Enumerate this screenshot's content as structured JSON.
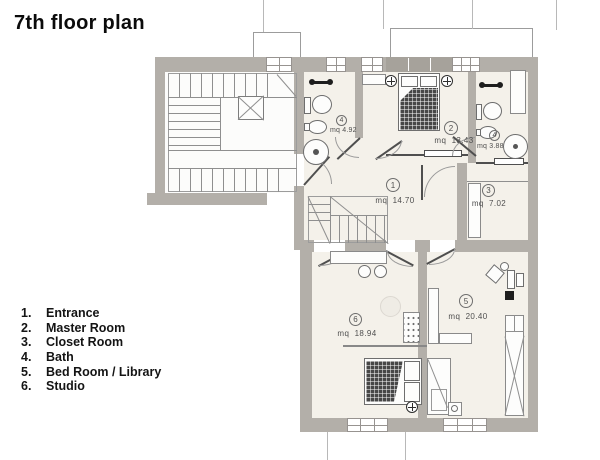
{
  "title": "7th floor plan",
  "legend": {
    "items": [
      {
        "num": "1.",
        "label": "Entrance"
      },
      {
        "num": "2.",
        "label": "Master Room"
      },
      {
        "num": "3.",
        "label": "Closet Room"
      },
      {
        "num": "4.",
        "label": "Bath"
      },
      {
        "num": "5.",
        "label": "Bed Room / Library"
      },
      {
        "num": "6.",
        "label": "Studio"
      }
    ]
  },
  "rooms": [
    {
      "id": "entrance",
      "number": "1",
      "area": "mq  14.70"
    },
    {
      "id": "master-room",
      "number": "2",
      "area": "mq  13.43"
    },
    {
      "id": "closet-room",
      "number": "3",
      "area": "mq  7.02"
    },
    {
      "id": "bath-main",
      "number": "4",
      "area": "mq 4.92"
    },
    {
      "id": "bath-ensuite",
      "number": "4",
      "area": "mq 3.88"
    },
    {
      "id": "bedroom-library",
      "number": "5",
      "area": "mq  20.40"
    },
    {
      "id": "studio",
      "number": "6",
      "area": "mq  18.94"
    }
  ],
  "icons": [
    "stairs",
    "elevator",
    "bed",
    "pillow",
    "toilet",
    "bidet",
    "sink",
    "shower",
    "towel-rail",
    "ceiling-lamp",
    "wardrobe",
    "cabinet",
    "radiator",
    "table",
    "chair",
    "desk",
    "door-swing",
    "sliding-door",
    "window",
    "terrace-railing"
  ],
  "colors": {
    "wall": "#b3afa9",
    "floor": "#f4f1ea",
    "thin_line": "#8f8f8f",
    "door": "#4f4f4f",
    "label_text": "#4f4f4f",
    "title_text": "#0b0b0b",
    "bed_blanket": "#474747"
  }
}
